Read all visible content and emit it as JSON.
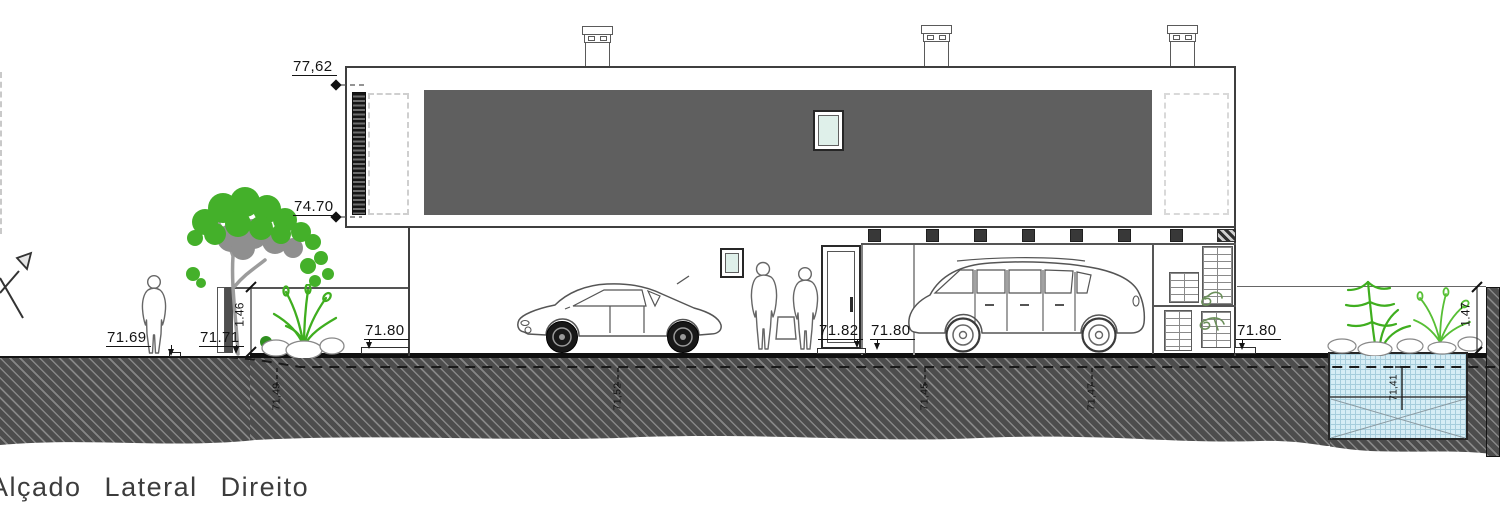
{
  "title": "Alçado Lateral Direito",
  "levels": {
    "roof": "77,62",
    "slab": "74.70",
    "ground_left": "71.69",
    "gate_base": "71.71",
    "gate_height": "1.46",
    "pavement_left": "71.80",
    "door_threshold": "71.82",
    "carport": "71.80",
    "pavement_right": "71.80",
    "wall_height": "1.47",
    "terrain_1": "71,49",
    "terrain_2": "71,52",
    "terrain_3": "71,45",
    "terrain_4": "71,47",
    "tank_bottom": "71,41"
  },
  "colors": {
    "facade_panel": "#5f5f5f",
    "ground_hatch": "#4d4d4d",
    "pool_water": "#d6edf5",
    "vegetation_green": "#44b02a",
    "line_ink": "#2b2b2b",
    "glass": "#dff0ea"
  }
}
